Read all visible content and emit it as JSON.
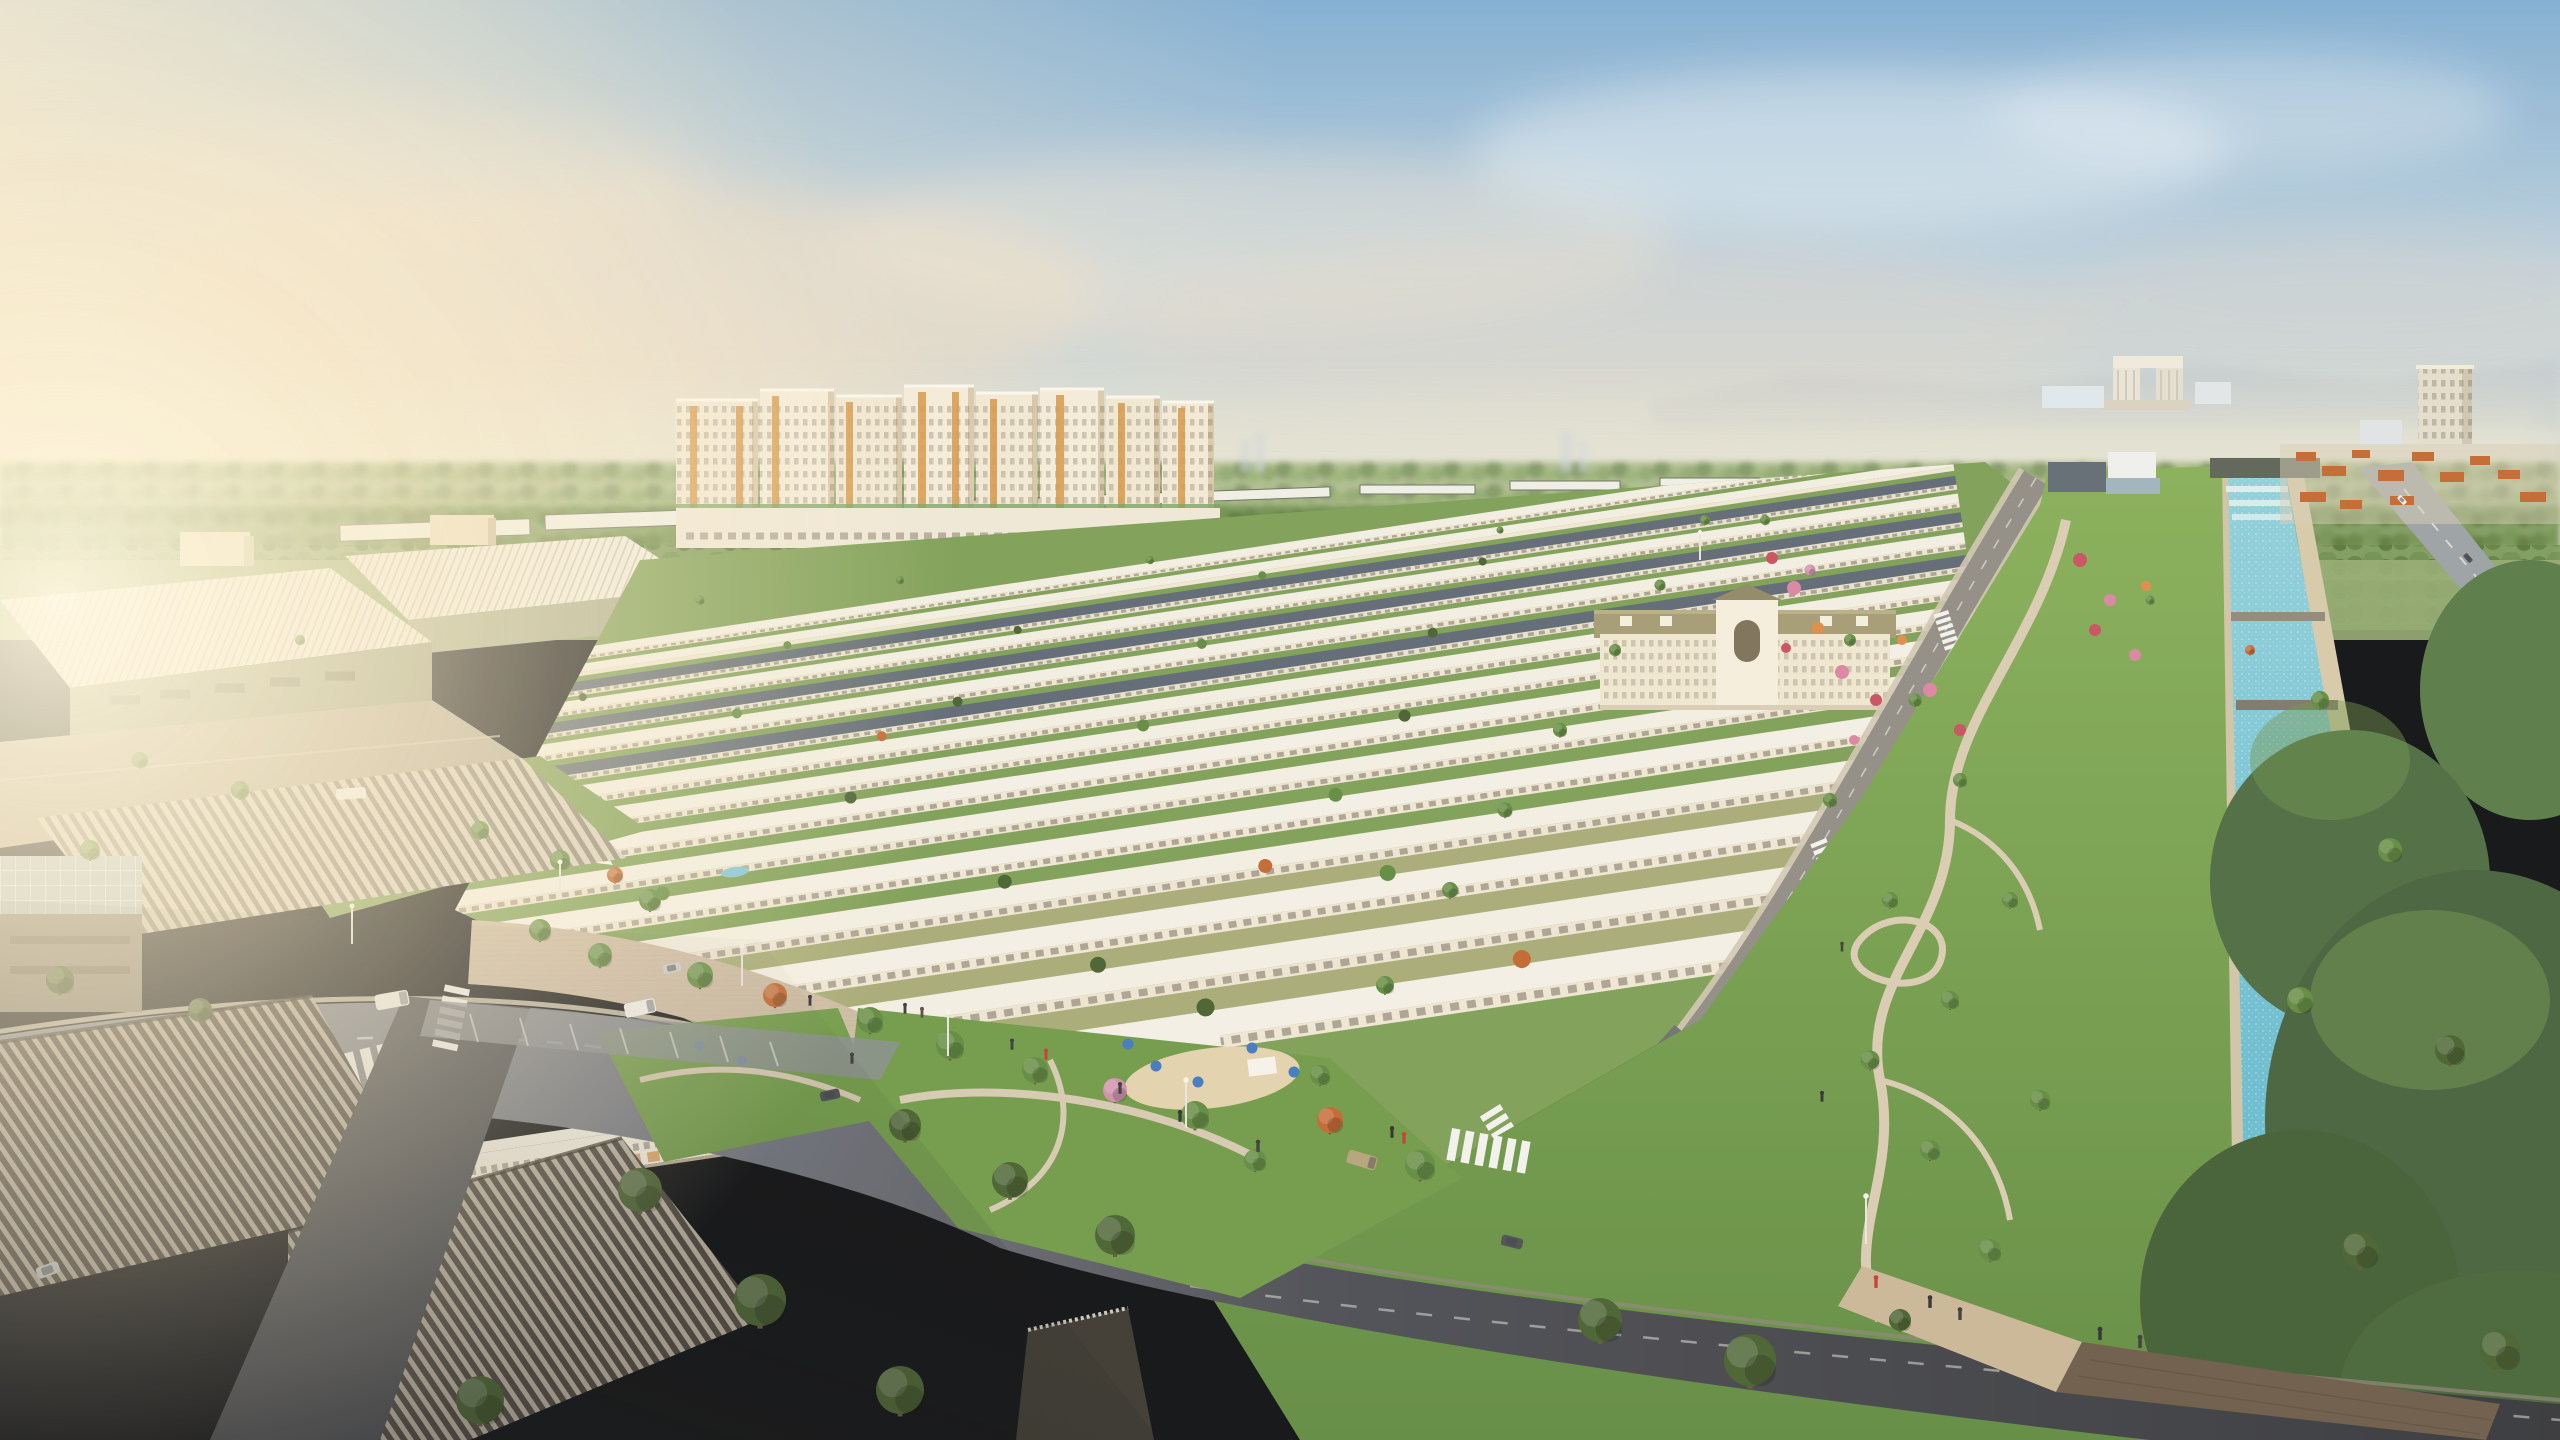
{
  "image": {
    "kind": "3d-architectural-aerial-rendering",
    "view": "oblique aerial at sunrise, warm haze from the left, clear blue sky upper right",
    "width_px": 2560,
    "height_px": 1440,
    "contains_text": false
  },
  "palette": {
    "sky_top": "#7fadd3",
    "sky_mid": "#b9cfdd",
    "sky_horizon": "#efe8d2",
    "sun_glow": "#fff6dd",
    "cloud_warm": "#eedbc2",
    "haze": "#ece7d2",
    "mountain": "#b6c0c9",
    "forest_far": "#aebd8e",
    "forest_near": "#7d9a5e",
    "midground_green": "#93ab72",
    "lawn": "#6f9a48",
    "lawn_bright": "#7c9e55",
    "tree_green": "#5f8a3f",
    "tree_dark": "#46602f",
    "tree_autumn": "#c2652f",
    "tree_pink": "#cf8fae",
    "flower_red": "#c64f5e",
    "flower_pink": "#d983a2",
    "roof_white": "#f2eee3",
    "facade_cream": "#f2e9d5",
    "facade_shade": "#d9c9ac",
    "accent_gold": "#d79a4e",
    "window_dark": "#5d5444",
    "roof_slate": "#5d6874",
    "roof_olive": "#a39b74",
    "clubhouse_wall": "#f0e7d2",
    "warehouse_wall": "#9aa083",
    "corrugated_light": "#b9b0a0",
    "corrugated_dark": "#4c463e",
    "glass_blue": "#b4c6ce",
    "road_light": "#8d919a",
    "road_dark": "#3c3e44",
    "asphalt_fore": "#35373c",
    "sidewalk": "#cfc5b2",
    "paver": "#cdbba4",
    "path_tan": "#d9cbb2",
    "crosswalk": "#f2f2ee",
    "canal_water": "#6fc0d4",
    "canal_water_deep": "#57b2c8",
    "canal_bank": "#cfc3a8",
    "bridge_deck": "#6a5a48",
    "umbrella_blue": "#3f78bf",
    "playground_sand": "#e3d2ae",
    "orange_roof": "#c2662f",
    "pylon_yellow": "#e8b83a",
    "car_white": "#f2f2f0",
    "car_silver": "#c9cdd1",
    "car_dark": "#4a4d52",
    "car_tan": "#b4a27a",
    "person_dark": "#3a3a3a",
    "person_red": "#c23b2e"
  },
  "regions": [
    {
      "name": "sky",
      "label": "Hazy sunrise sky"
    },
    {
      "name": "sun-glow",
      "label": "Warm sun glow washing in from the left"
    },
    {
      "name": "clouds",
      "label": "Soft peach and white haze clouds"
    },
    {
      "name": "mountains",
      "label": "Faint distant ridge on the right horizon"
    },
    {
      "name": "horizon-forest",
      "label": "Continuous tree line on the horizon"
    },
    {
      "name": "distant-skyline",
      "label": "Far high-rises fading into haze"
    },
    {
      "name": "gateway-towers",
      "label": "Twin linked towers on the horizon"
    },
    {
      "name": "east-tower",
      "label": "Distant cream high-rise east of the canal"
    },
    {
      "name": "tower-cluster",
      "label": "Cluster of ~20-storey cream apartment towers with gold accent strips"
    },
    {
      "name": "podium-row",
      "label": "Low shophouse podium at the towers' base"
    },
    {
      "name": "townhouse-grid",
      "label": "Dense rows of white townhouses receding to the right"
    },
    {
      "name": "clubhouse",
      "label": "Beige classical clubhouse with olive hip roof and arched centre"
    },
    {
      "name": "shophouse-row",
      "label": "Three-storey shophouses with warm lit storefronts"
    },
    {
      "name": "promenade",
      "label": "Paved promenade with lawns and cafe umbrellas"
    },
    {
      "name": "entrance-plaza",
      "label": "Entrance lawn with white ribbon sculpture and brand pylon"
    },
    {
      "name": "industrial-park",
      "label": "White-roofed factory park on the left in sun haze"
    },
    {
      "name": "glass-hall",
      "label": "Hall with glazed grid roof"
    },
    {
      "name": "foreground-warehouses",
      "label": "Large corrugated-roof warehouses in foreground shadow"
    },
    {
      "name": "main-avenue",
      "label": "Curving main avenue with crosswalks, lane dashes and cars"
    },
    {
      "name": "edge-street",
      "label": "Street between the townhouse grid and the linear park"
    },
    {
      "name": "pocket-park",
      "label": "Central pocket park"
    },
    {
      "name": "playground",
      "label": "Sandy playground with blue umbrellas"
    },
    {
      "name": "linear-park",
      "label": "Winding linear park along the canal"
    },
    {
      "name": "flower-gardens",
      "label": "Pink and red flower beds"
    },
    {
      "name": "canal",
      "label": "Turquoise landscaped canal"
    },
    {
      "name": "canal-weir",
      "label": "Stepped weir at the canal head"
    },
    {
      "name": "footbridges",
      "label": "Small footbridges across the canal"
    },
    {
      "name": "pedestrian-bridge",
      "label": "Broad timber deck crossing the canal at bottom right"
    },
    {
      "name": "east-bank",
      "label": "Dense tree belt east of the canal"
    },
    {
      "name": "right-avenue",
      "label": "Tree-lined avenue at top right"
    },
    {
      "name": "villas",
      "label": "Terracotta-roofed villas in the distance"
    },
    {
      "name": "vehicles",
      "label": "Cars, vans and a bus on the streets"
    },
    {
      "name": "pedestrians",
      "label": "Tiny figures on walkways and the bridge"
    }
  ]
}
